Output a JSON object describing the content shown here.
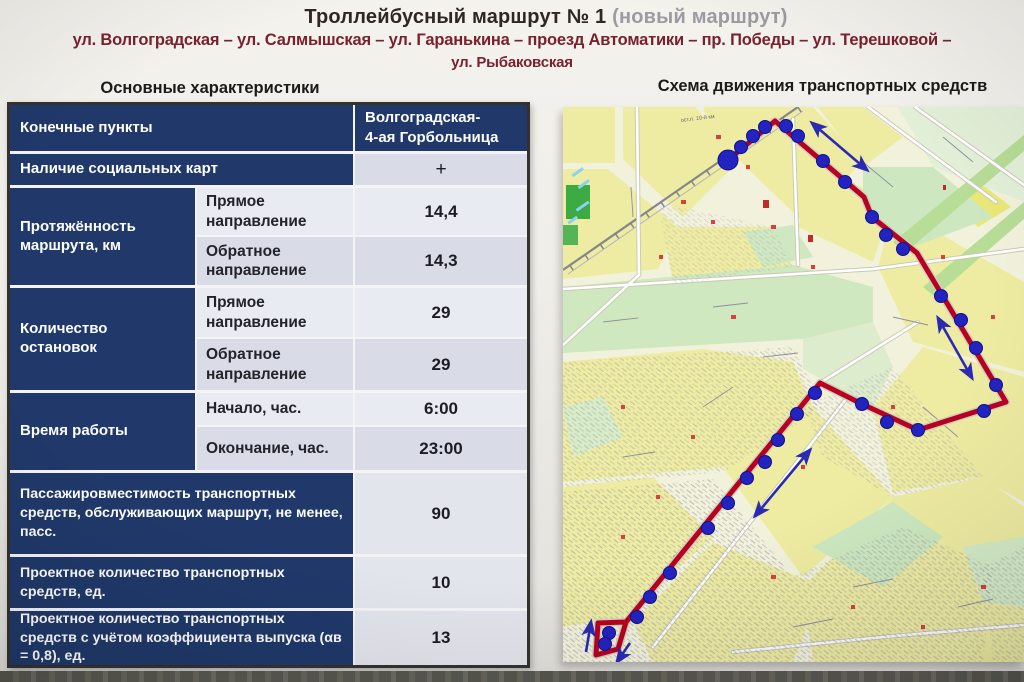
{
  "slide": {
    "title": "Троллейбусный маршрут № 1",
    "title_note": "(новый маршрут)",
    "route_line1": "ул. Волгоградская – ул. Салмышская – ул. Гаранькина – проезд Автоматики – пр. Победы – ул. Терешковой –",
    "route_line2": "ул. Рыбаковская",
    "left_heading": "Основные характеристики",
    "right_heading": "Схема движения транспортных средств"
  },
  "table": {
    "endpoints_label": "Конечные пункты",
    "endpoints_value_line1": "Волгоградская-",
    "endpoints_value_line2": "4-ая Горбольница",
    "rows": {
      "social_cards": {
        "label": "Наличие социальных карт",
        "value": "+"
      },
      "length": {
        "label": "Протяжённость маршрута, км",
        "forward": {
          "label": "Прямое направление",
          "value": "14,4"
        },
        "backward": {
          "label": "Обратное направление",
          "value": "14,3"
        }
      },
      "stops": {
        "label": "Количество остановок",
        "forward": {
          "label": "Прямое направление",
          "value": "29"
        },
        "backward": {
          "label": "Обратное направление",
          "value": "29"
        }
      },
      "hours": {
        "label": "Время работы",
        "start": {
          "label": "Начало, час.",
          "value": "6:00"
        },
        "end": {
          "label": "Окончание, час.",
          "value": "23:00"
        }
      },
      "capacity": {
        "label": "Пассажировместимость транспортных средств, обслуживающих маршрут, не менее, пасс.",
        "value": "90"
      },
      "planned_vehicles": {
        "label": "Проектное количество транспортных средств, ед.",
        "value": "10"
      },
      "planned_vehicles_coeff": {
        "label": "Проектное количество транспортных средств с учётом коэффициента выпуска (αв = 0,8), ед.",
        "value": "13"
      }
    },
    "colors": {
      "header_bg": "#20396a",
      "cell_light": "#e9ebf2",
      "cell_dark": "#d9dce6"
    }
  },
  "map": {
    "label_stop": "ост.п. 10-й км",
    "route_color": "#b80020",
    "stop_color": "#2323c0",
    "arrow_color": "#2a2ab2",
    "route_points": [
      [
        165,
        53
      ],
      [
        212,
        14
      ],
      [
        301,
        90
      ],
      [
        309,
        110
      ],
      [
        354,
        146
      ],
      [
        443,
        295
      ],
      [
        355,
        323
      ],
      [
        299,
        297
      ],
      [
        257,
        276
      ],
      [
        63,
        515
      ],
      [
        35,
        516
      ],
      [
        33,
        548
      ],
      [
        55,
        542
      ],
      [
        63,
        515
      ]
    ],
    "terminal": [
      165,
      53
    ],
    "stops": [
      [
        178,
        40
      ],
      [
        190,
        29
      ],
      [
        202,
        20
      ],
      [
        223,
        19
      ],
      [
        235,
        29
      ],
      [
        260,
        54
      ],
      [
        282,
        75
      ],
      [
        309,
        110
      ],
      [
        323,
        128
      ],
      [
        340,
        142
      ],
      [
        378,
        189
      ],
      [
        398,
        213
      ],
      [
        413,
        241
      ],
      [
        433,
        278
      ],
      [
        421,
        304
      ],
      [
        355,
        323
      ],
      [
        324,
        315
      ],
      [
        299,
        297
      ],
      [
        252,
        286
      ],
      [
        234,
        307
      ],
      [
        215,
        333
      ],
      [
        202,
        355
      ],
      [
        184,
        371
      ],
      [
        165,
        396
      ],
      [
        145,
        421
      ],
      [
        107,
        466
      ],
      [
        87,
        490
      ],
      [
        74,
        510
      ],
      [
        46,
        526
      ],
      [
        42,
        537
      ]
    ],
    "arrows": [
      {
        "x1": 249,
        "y1": 16,
        "x2": 304,
        "y2": 63,
        "double": true
      },
      {
        "x1": 375,
        "y1": 211,
        "x2": 409,
        "y2": 271,
        "double": true
      },
      {
        "x1": 247,
        "y1": 343,
        "x2": 192,
        "y2": 409,
        "double": true
      },
      {
        "x1": 23,
        "y1": 545,
        "x2": 28,
        "y2": 515,
        "double": false
      },
      {
        "x1": 67,
        "y1": 536,
        "x2": 54,
        "y2": 555,
        "double": false
      }
    ]
  }
}
